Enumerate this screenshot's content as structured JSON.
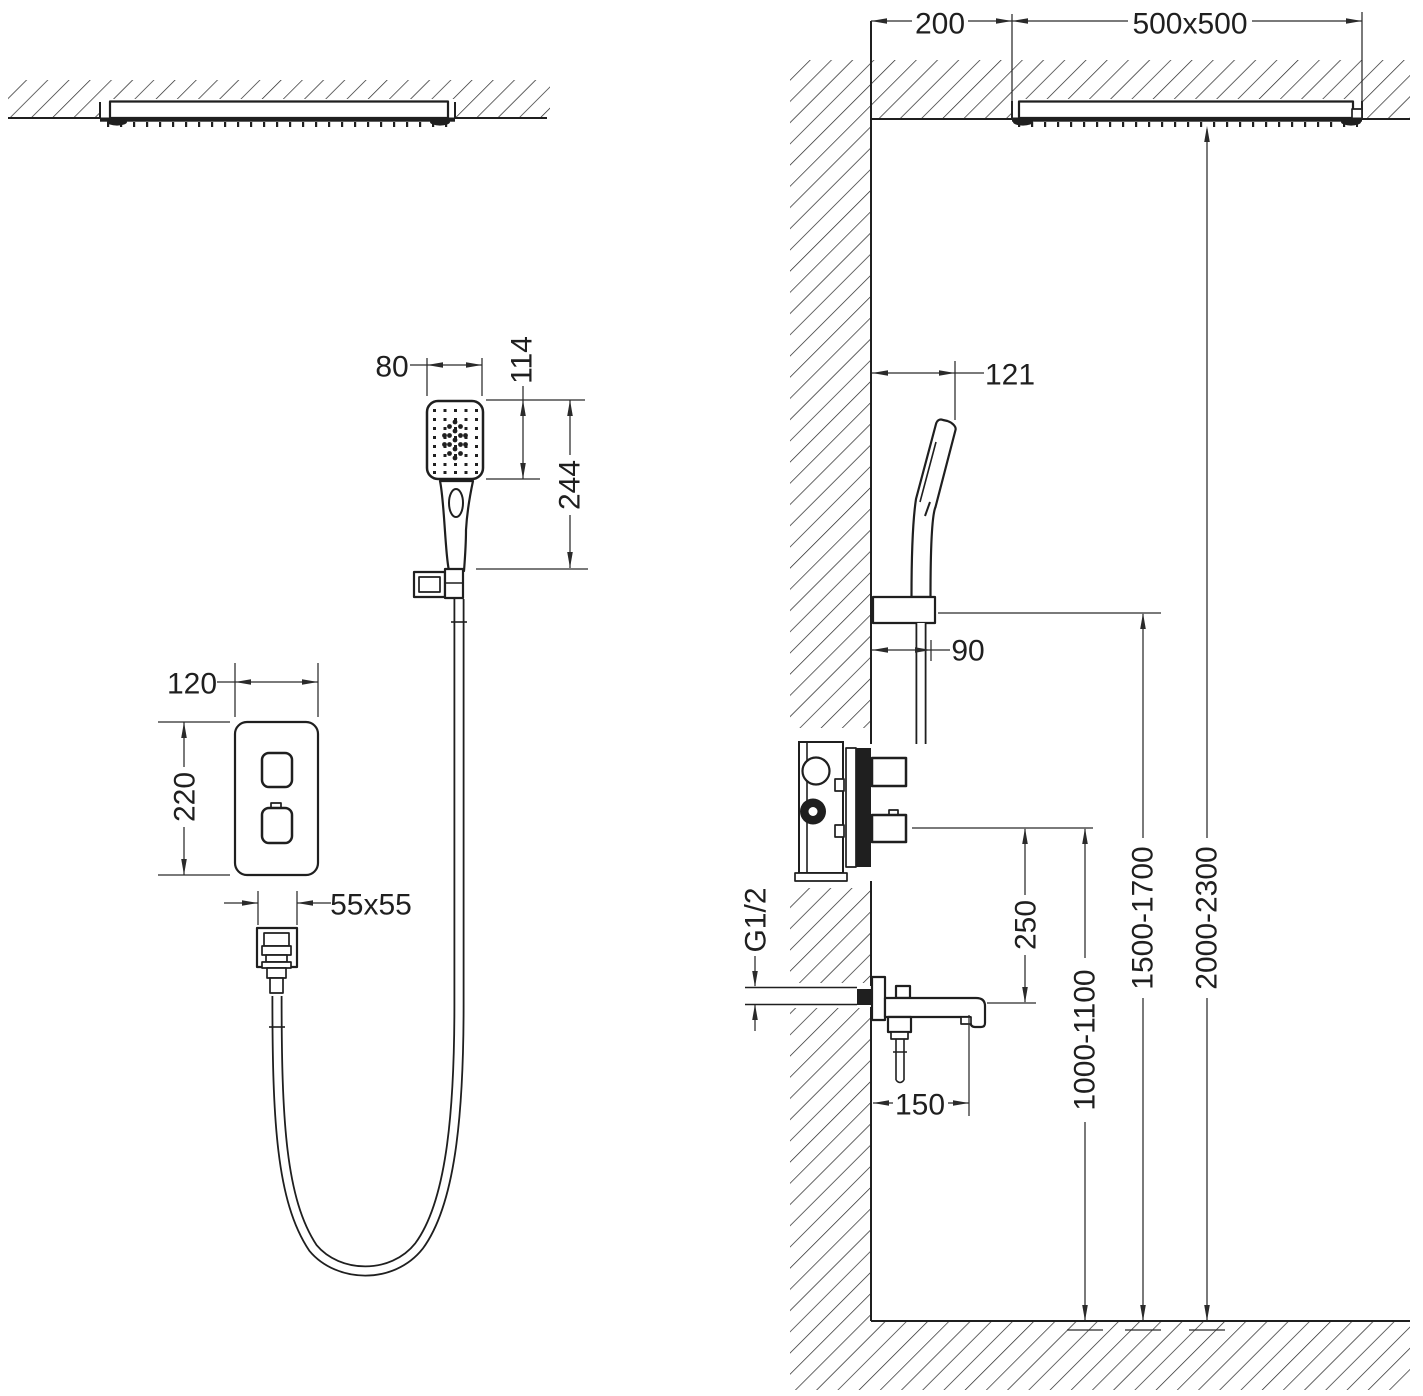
{
  "labels": {
    "hand_shower_width": "80",
    "hand_shower_head_height": "114",
    "hand_shower_length": "244",
    "mixer_panel_width": "120",
    "mixer_panel_height": "220",
    "outlet_plate_size": "55x55",
    "head_wall_offset": "200",
    "head_size": "500x500",
    "holder_wall_offset": "121",
    "hose_wall_offset": "90",
    "pipe_thread": "G1/2",
    "knob_to_spout": "250",
    "spout_mount_height": "1000-1100",
    "holder_mount_height": "1500-1700",
    "head_mount_height": "2000-2300",
    "spout_length": "150"
  },
  "colors": {
    "line": "#1f1f1f",
    "dimension": "#2a2a2a",
    "background": "#ffffff"
  }
}
